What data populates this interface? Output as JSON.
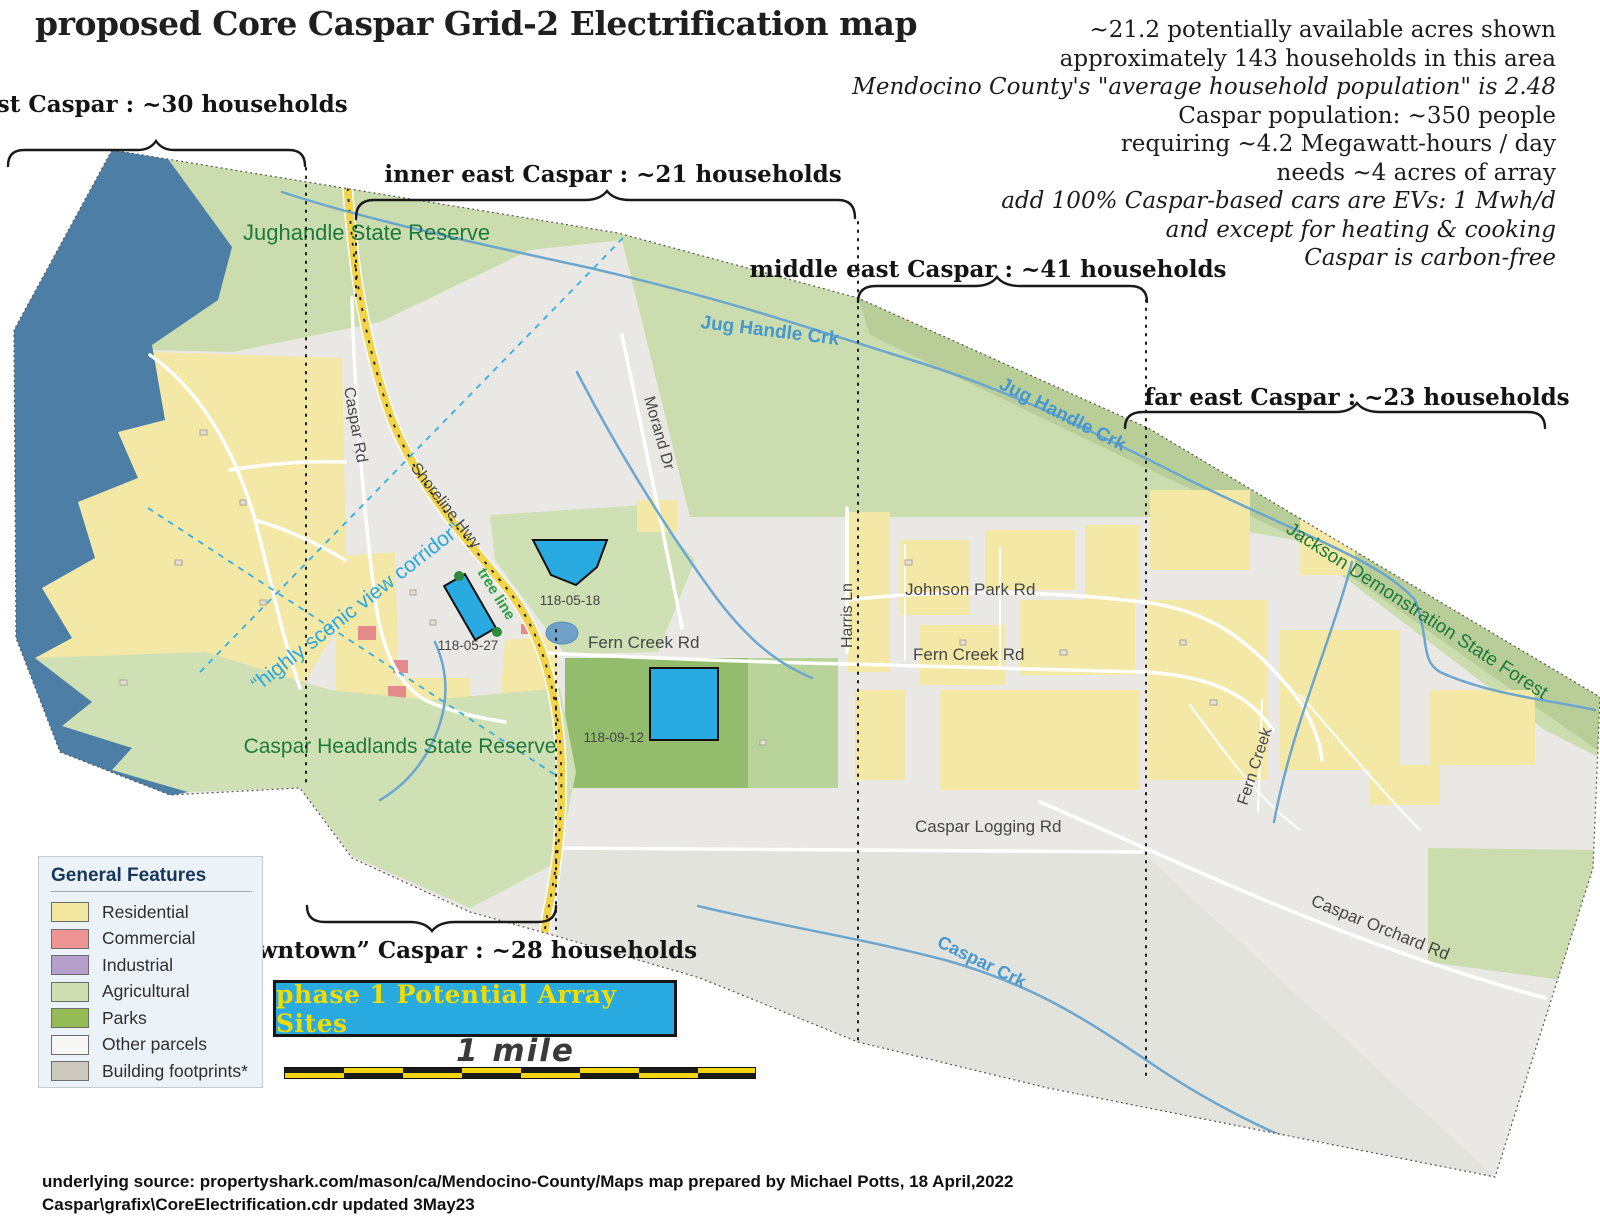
{
  "title": "proposed Core Caspar Grid-2 Electrification map",
  "info_block": {
    "lines": [
      "~21.2 potentially available acres shown",
      "approximately 143 households in this area",
      "Mendocino County's \"average household population\" is 2.48",
      "Caspar population: ~350 people",
      "requiring ~4.2 Megawatt-hours / day",
      "needs ~4 acres of array",
      "add 100% Caspar-based cars are EVs: 1 Mwh/d",
      "and except for heating & cooking",
      "Caspar is carbon-free"
    ]
  },
  "regions": {
    "west": "west Caspar : ~30 households",
    "inner_east": "inner east Caspar : ~21 households",
    "middle_east": "middle east Caspar : ~41 households",
    "far_east": "far east Caspar : ~23 households",
    "downtown": "“downtown” Caspar : ~28 households"
  },
  "map_labels": {
    "jughandle_reserve": "Jughandle State Reserve",
    "headlands_reserve": "Caspar Headlands State Reserve",
    "jackson_forest": "Jackson Demonstration State Forest",
    "jug_handle_creek": "Jug Handle Crk",
    "caspar_creek": "Caspar Crk",
    "fern_creek": "Fern Creek",
    "scenic_corridor": "“highly scenic view corridor”",
    "tree_line": "tree line",
    "roads": {
      "caspar_rd": "Caspar Rd",
      "shoreline_hwy": "Shoreline Hwy",
      "morand_dr": "Morand Dr",
      "harris_ln": "Harris Ln",
      "johnson_park_rd": "Johnson Park Rd",
      "fern_creek_rd": "Fern Creek Rd",
      "caspar_logging_rd": "Caspar Logging Rd",
      "caspar_orchard_rd": "Caspar Orchard Rd"
    },
    "parcels": {
      "p1": "118-05-18",
      "p2": "118-05-27",
      "p3": "118-09-12"
    }
  },
  "legend": {
    "title": "General Features",
    "items": [
      {
        "label": "Residential",
        "color": "#F2E6A0"
      },
      {
        "label": "Commercial",
        "color": "#EE9494"
      },
      {
        "label": "Industrial",
        "color": "#B69FCB"
      },
      {
        "label": "Agricultural",
        "color": "#CFDFB2"
      },
      {
        "label": "Parks",
        "color": "#94BB55"
      },
      {
        "label": "Other parcels",
        "color": "#F7F7F5"
      },
      {
        "label": "Building footprints*",
        "color": "#CEC9BF"
      }
    ]
  },
  "array_sites": {
    "label": "phase 1 Potential Array Sites"
  },
  "scale": {
    "label": "1 mile"
  },
  "source": {
    "line1": "underlying source: propertyshark.com/mason/ca/Mendocino-County/Maps map prepared by Michael Potts, 18 April,2022",
    "line2": "Caspar\\grafix\\CoreElectrification.cdr updated 3May23"
  },
  "colors": {
    "ocean": "#4D7FA6",
    "agricultural": "#CBDCAE",
    "forest_band": "#B9CD99",
    "parks": "#93BD6C",
    "residential": "#F4E8A6",
    "commercial": "#E58A8A",
    "other_parcels": "#E9E8E4",
    "array_site_blue": "#29ABE2",
    "highway_yellow": "#F2D44C",
    "creek_blue": "#6CA6CE",
    "reserve_text_green": "#1E7A3C",
    "scenic_text_blue": "#2BA7DF"
  }
}
